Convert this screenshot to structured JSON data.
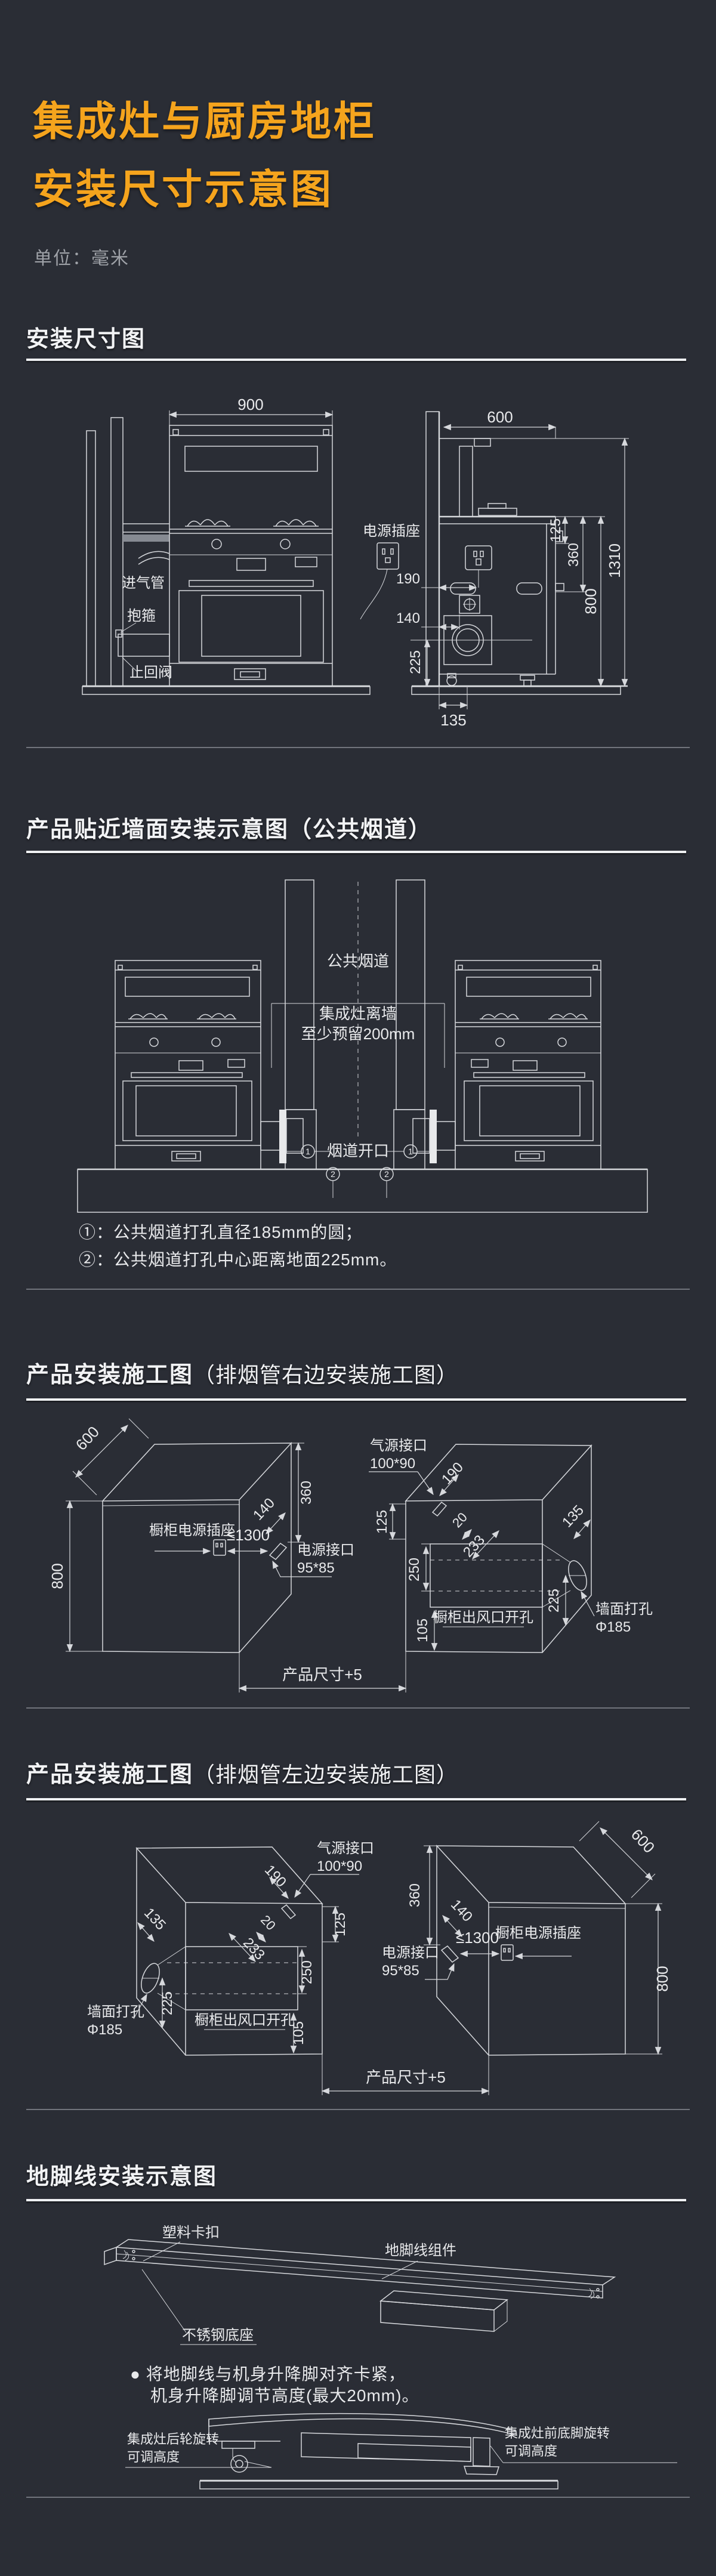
{
  "page": {
    "bg": "#2a2d35",
    "accent": "#f5a41d",
    "line_color": "#d6d8dc"
  },
  "header": {
    "title_line1": "集成灶与厨房地柜",
    "title_line2": "安装尺寸示意图",
    "unit": "单位：毫米"
  },
  "s1": {
    "heading": "安装尺寸图",
    "labels": {
      "intake_pipe": "进气管",
      "clamp": "抱箍",
      "check_valve": "止回阀",
      "power_socket": "电源插座"
    },
    "dims": {
      "w900": "900",
      "d600": "600",
      "h1310": "1310",
      "h800": "800",
      "d125": "125",
      "d360": "360",
      "d190": "190",
      "d140": "140",
      "d225": "225",
      "d135": "135"
    }
  },
  "s2": {
    "heading": "产品贴近墙面安装示意图（公共烟道）",
    "labels": {
      "shared_flue": "公共烟道",
      "clearance_line1": "集成灶离墙",
      "clearance_line2": "至少预留200mm",
      "flue_opening": "烟道开口",
      "marker1": "1",
      "marker2": "2"
    },
    "notes": {
      "note1": "①：公共烟道打孔直径185mm的圆；",
      "note2": "②：公共烟道打孔中心距离地面225mm。"
    }
  },
  "s3": {
    "heading_main": "产品安装施工图",
    "heading_sub": "（排烟管右边安装施工图）",
    "labels": {
      "cabinet_socket": "橱柜电源插座",
      "power_port1": "电源接口",
      "power_port2": "95*85",
      "gas_port1": "气源接口",
      "gas_port2": "100*90",
      "outlet_cutout": "橱柜出风口开孔",
      "wall_hole1": "墙面打孔",
      "wall_hole2": "Φ185",
      "product_size": "产品尺寸+5"
    },
    "dims": {
      "d600": "600",
      "d800": "800",
      "d360": "360",
      "d140": "140",
      "d1300": "≤1300",
      "d190": "190",
      "d125": "125",
      "d20": "20",
      "d233": "233",
      "d250": "250",
      "d105": "105",
      "d135": "135",
      "d225": "225"
    }
  },
  "s4": {
    "heading_main": "产品安装施工图",
    "heading_sub": "（排烟管左边安装施工图）",
    "labels": {
      "cabinet_socket": "橱柜电源插座",
      "power_port1": "电源接口",
      "power_port2": "95*85",
      "gas_port1": "气源接口",
      "gas_port2": "100*90",
      "outlet_cutout": "橱柜出风口开孔",
      "wall_hole1": "墙面打孔",
      "wall_hole2": "Φ185",
      "product_size": "产品尺寸+5"
    },
    "dims": {
      "d600": "600",
      "d800": "800",
      "d360": "360",
      "d140": "140",
      "d1300": "≤1300",
      "d190": "190",
      "d125": "125",
      "d20": "20",
      "d233": "233",
      "d250": "250",
      "d105": "105",
      "d135": "135",
      "d225": "225"
    }
  },
  "s5": {
    "heading": "地脚线安装示意图",
    "labels": {
      "plastic_clip": "塑料卡扣",
      "baseboard_assembly": "地脚线组件",
      "steel_base": "不锈钢底座",
      "rear_wheel_line1": "集成灶后轮旋转",
      "rear_wheel_line2": "可调高度",
      "front_foot_line1": "集成灶前底脚旋转",
      "front_foot_line2": "可调高度"
    },
    "notes": {
      "bullet": "●",
      "line1": "将地脚线与机身升降脚对齐卡紧，",
      "line2": "机身升降脚调节高度(最大20mm)。"
    }
  }
}
